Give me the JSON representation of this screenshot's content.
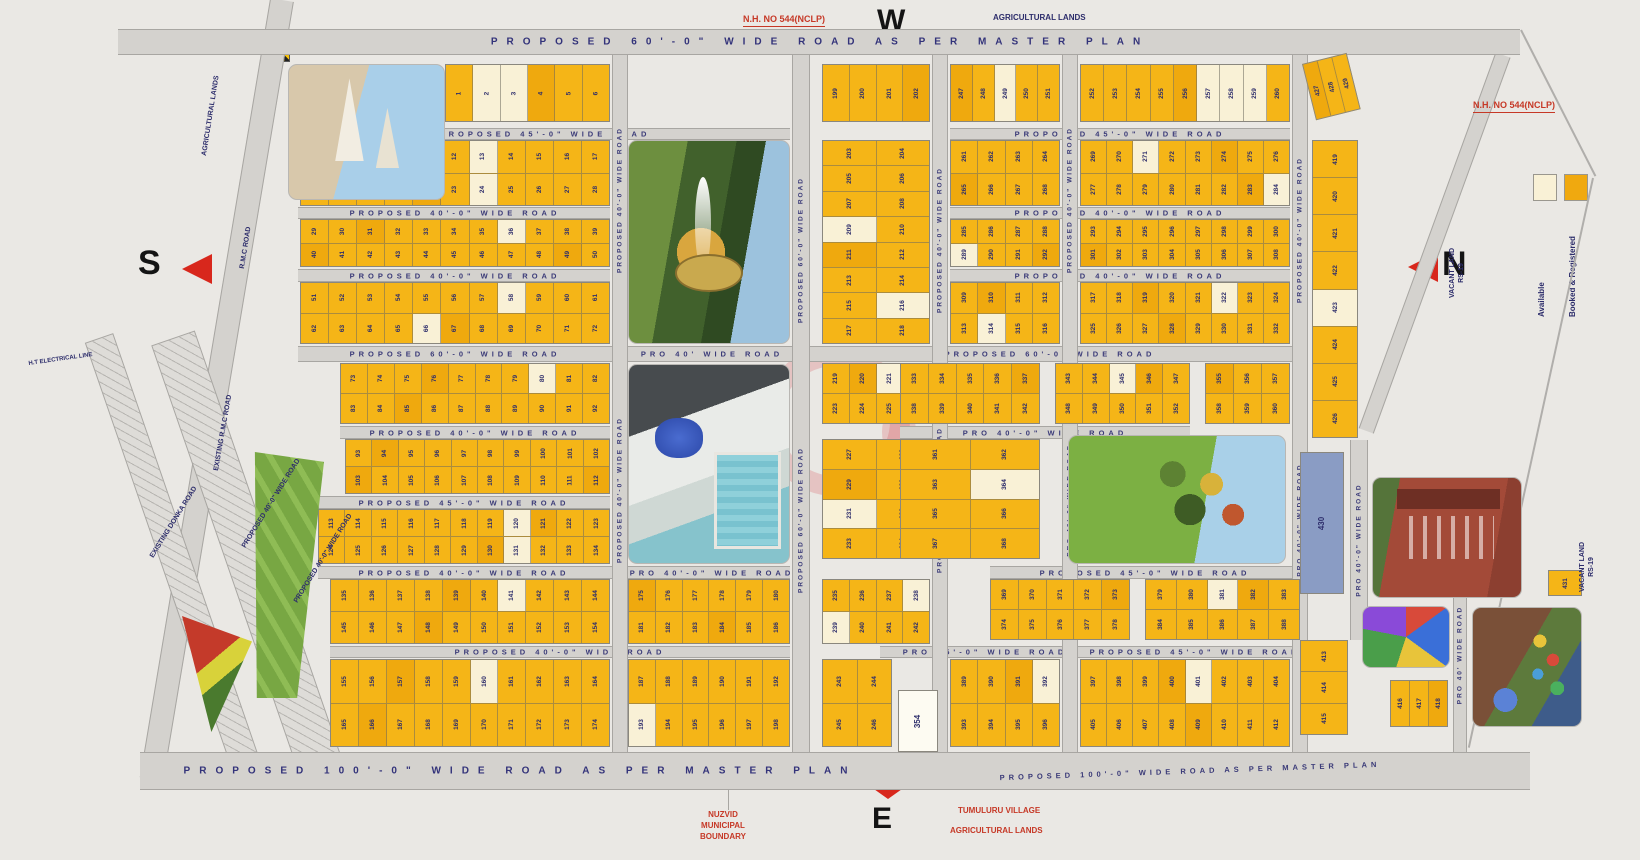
{
  "compass": {
    "west": "W",
    "south": "S",
    "north": "N",
    "east": "E"
  },
  "legend": {
    "available_label": "Available",
    "booked_label": "Booked & Registered",
    "available_color": "#F9F1D6",
    "booked_color": "#F0A90F"
  },
  "colors": {
    "booked": "#F5B517",
    "booked_alt": "#EFA90E",
    "available": "#F9F1D6",
    "navy": "#2D2D6B",
    "red": "#C63826",
    "road": "#D4D2CE",
    "blue_plot": "#8A9CC4"
  },
  "roads_h": [
    {
      "x": 118,
      "y": 29,
      "w": 1402,
      "h": 26,
      "labels": [
        {
          "t": "PROPOSED  60'-0\"  WIDE  ROAD  AS  PER  MASTER  PLAN",
          "cx": 820,
          "big": true
        }
      ]
    },
    {
      "x": 298,
      "y": 128,
      "w": 492,
      "h": 12,
      "labels": [
        {
          "t": "PROPOSED  45'-0\"  WIDE  ROAD",
          "cx": 545
        }
      ]
    },
    {
      "x": 950,
      "y": 128,
      "w": 340,
      "h": 12,
      "labels": [
        {
          "t": "PROPOSED  45'-0\"  WIDE  ROAD",
          "cx": 1120
        }
      ]
    },
    {
      "x": 298,
      "y": 207,
      "w": 312,
      "h": 12,
      "labels": [
        {
          "t": "PROPOSED  40'-0\"  WIDE  ROAD",
          "cx": 455
        }
      ]
    },
    {
      "x": 950,
      "y": 207,
      "w": 340,
      "h": 12,
      "labels": [
        {
          "t": "PROPOSED  40'-0\"  WIDE  ROAD",
          "cx": 1120
        }
      ]
    },
    {
      "x": 298,
      "y": 269,
      "w": 312,
      "h": 13,
      "labels": [
        {
          "t": "PROPOSED  40'-0\"  WIDE  ROAD",
          "cx": 455
        }
      ]
    },
    {
      "x": 950,
      "y": 269,
      "w": 340,
      "h": 13,
      "labels": [
        {
          "t": "PROPOSED  40'-0\"  WIDE  ROAD",
          "cx": 1120
        }
      ]
    },
    {
      "x": 298,
      "y": 346,
      "w": 1002,
      "h": 16,
      "labels": [
        {
          "t": "PROPOSED  60'-0\"  WIDE  ROAD",
          "cx": 455
        },
        {
          "t": "PRO  40'  WIDE  ROAD",
          "cx": 712
        },
        {
          "t": "PROPOSED  60'-0\"  WIDE  ROAD",
          "cx": 1050
        }
      ]
    },
    {
      "x": 340,
      "y": 426,
      "w": 270,
      "h": 13,
      "labels": [
        {
          "t": "PROPOSED  40'-0\"  WIDE  ROAD",
          "cx": 475
        }
      ]
    },
    {
      "x": 900,
      "y": 426,
      "w": 290,
      "h": 13,
      "labels": [
        {
          "t": "PRO  40'-0\"  WIDE  ROAD",
          "cx": 1045
        }
      ]
    },
    {
      "x": 318,
      "y": 496,
      "w": 292,
      "h": 13,
      "labels": [
        {
          "t": "PROPOSED  45'-0\"  WIDE  ROAD",
          "cx": 464
        }
      ]
    },
    {
      "x": 318,
      "y": 566,
      "w": 472,
      "h": 13,
      "labels": [
        {
          "t": "PROPOSED  40'-0\"  WIDE  ROAD",
          "cx": 464
        },
        {
          "t": "PRO  40'-0\"  WIDE  ROAD",
          "cx": 712
        }
      ]
    },
    {
      "x": 990,
      "y": 566,
      "w": 310,
      "h": 13,
      "labels": [
        {
          "t": "PROPOSED  45'-0\"  WIDE  ROAD",
          "cx": 1145
        }
      ]
    },
    {
      "x": 330,
      "y": 646,
      "w": 460,
      "h": 12,
      "labels": [
        {
          "t": "PROPOSED  40'-0\"  WIDE  ROAD",
          "cx": 560
        }
      ]
    },
    {
      "x": 880,
      "y": 646,
      "w": 420,
      "h": 12,
      "labels": [
        {
          "t": "PRO  45'-0\"  WIDE  ROAD",
          "cx": 985
        },
        {
          "t": "PROPOSED  45'-0\"  WIDE  ROAD",
          "cx": 1195
        }
      ]
    },
    {
      "x": 140,
      "y": 752,
      "w": 1390,
      "h": 38,
      "labels": [
        {
          "t": "PROPOSED  100'-0\"  WIDE  ROAD  AS  PER  MASTER  PLAN",
          "cx": 520,
          "big": true
        },
        {
          "t": "PROPOSED  100'-0\"  WIDE  ROAD  AS  PER  MASTER  PLAN",
          "cx": 1190,
          "rot": -2
        }
      ]
    }
  ],
  "roads_v": [
    {
      "x": 612,
      "y": 55,
      "w": 16,
      "h": 697,
      "labels": [
        {
          "t": "PROPOSED 40'-0\" WIDE ROAD",
          "cy": 200
        },
        {
          "t": "PROPOSED 40'-0\" WIDE ROAD",
          "cy": 490
        }
      ]
    },
    {
      "x": 792,
      "y": 55,
      "w": 18,
      "h": 697,
      "labels": [
        {
          "t": "PROPOSED 60'-0\" WIDE ROAD",
          "cy": 250
        },
        {
          "t": "PROPOSED 60'-0\" WIDE ROAD",
          "cy": 520
        }
      ]
    },
    {
      "x": 932,
      "y": 55,
      "w": 16,
      "h": 697,
      "labels": [
        {
          "t": "PROPOSED 40'-0\" WIDE ROAD",
          "cy": 240
        },
        {
          "t": "PROPOSED 40'-0\" WIDE ROAD",
          "cy": 500
        }
      ]
    },
    {
      "x": 1062,
      "y": 55,
      "w": 16,
      "h": 697,
      "labels": [
        {
          "t": "PROPOSED 40'-0\" WIDE ROAD",
          "cy": 200
        },
        {
          "t": "PRO 40'-0\" WIDE ROAD",
          "cy": 500
        }
      ]
    },
    {
      "x": 1292,
      "y": 55,
      "w": 16,
      "h": 697,
      "labels": [
        {
          "t": "PROPOSED 40'-0\" WIDE ROAD",
          "cy": 230
        },
        {
          "t": "PRO 40'-0\" WIDE ROAD",
          "cy": 520
        }
      ]
    },
    {
      "x": 1350,
      "y": 440,
      "w": 18,
      "h": 200,
      "labels": [
        {
          "t": "PRO 40'-0\" WIDE ROAD",
          "cy": 540
        }
      ]
    },
    {
      "x": 1453,
      "y": 560,
      "w": 14,
      "h": 192,
      "labels": [
        {
          "t": "PRO 40' WIDE ROAD",
          "cy": 655
        }
      ]
    }
  ],
  "roads_diag": [
    {
      "x": 270,
      "y": 0,
      "w": 24,
      "h": 790,
      "rot": 9.5,
      "cls": "dsolid"
    },
    {
      "x": 1495,
      "y": 55,
      "w": 16,
      "h": 400,
      "rot": 20,
      "cls": "dsolid"
    },
    {
      "x": 84,
      "y": 338,
      "w": 30,
      "h": 460,
      "rot": -19,
      "cls": "hatch"
    },
    {
      "x": 150,
      "y": 338,
      "w": 46,
      "h": 460,
      "rot": -19,
      "cls": "hatch"
    },
    {
      "x": 1592,
      "y": 178,
      "w": 2,
      "h": 583,
      "rot": 12.3,
      "cls": "dline"
    },
    {
      "x": 1520,
      "y": 30,
      "w": 2,
      "h": 164,
      "rot": -27,
      "cls": "dline"
    }
  ],
  "blocks": [
    {
      "x": 445,
      "y": 64,
      "w": 165,
      "h": 58,
      "s": 1,
      "r": 1,
      "c": 6,
      "a": [
        2,
        3
      ]
    },
    {
      "x": 300,
      "y": 140,
      "w": 310,
      "h": 66,
      "s": 7,
      "r": 2,
      "c": 11,
      "a": [
        13,
        24
      ]
    },
    {
      "x": 300,
      "y": 219,
      "w": 310,
      "h": 48,
      "s": 29,
      "r": 2,
      "c": 11,
      "a": [
        36
      ]
    },
    {
      "x": 300,
      "y": 282,
      "w": 310,
      "h": 62,
      "s": 51,
      "r": 2,
      "c": 11,
      "a": [
        58,
        66
      ]
    },
    {
      "x": 340,
      "y": 363,
      "w": 270,
      "h": 61,
      "s": 73,
      "r": 2,
      "c": 10,
      "a": [
        80
      ]
    },
    {
      "x": 345,
      "y": 439,
      "w": 265,
      "h": 55,
      "s": 93,
      "r": 2,
      "c": 10,
      "a": []
    },
    {
      "x": 318,
      "y": 509,
      "w": 292,
      "h": 55,
      "s": 113,
      "r": 2,
      "c": 11,
      "a": [
        120,
        131
      ]
    },
    {
      "x": 330,
      "y": 579,
      "w": 280,
      "h": 65,
      "s": 135,
      "r": 2,
      "c": 10,
      "a": [
        141
      ]
    },
    {
      "x": 330,
      "y": 659,
      "w": 280,
      "h": 88,
      "s": 155,
      "r": 2,
      "c": 10,
      "a": [
        160
      ]
    },
    {
      "x": 628,
      "y": 579,
      "w": 162,
      "h": 65,
      "s": 175,
      "r": 2,
      "c": 6,
      "a": []
    },
    {
      "x": 628,
      "y": 659,
      "w": 162,
      "h": 88,
      "s": 187,
      "r": 2,
      "c": 6,
      "a": [
        193
      ]
    },
    {
      "x": 822,
      "y": 64,
      "w": 108,
      "h": 58,
      "s": 199,
      "r": 1,
      "c": 4,
      "a": []
    },
    {
      "x": 822,
      "y": 140,
      "w": 108,
      "h": 204,
      "s": 203,
      "r": 8,
      "c": 2,
      "a": [
        209,
        216
      ]
    },
    {
      "x": 822,
      "y": 363,
      "w": 108,
      "h": 61,
      "s": 219,
      "r": 2,
      "c": 4,
      "a": [
        221
      ]
    },
    {
      "x": 822,
      "y": 439,
      "w": 108,
      "h": 120,
      "s": 227,
      "r": 4,
      "c": 2,
      "a": [
        231
      ]
    },
    {
      "x": 822,
      "y": 579,
      "w": 108,
      "h": 65,
      "s": 235,
      "r": 2,
      "c": 4,
      "a": [
        238,
        239
      ]
    },
    {
      "x": 822,
      "y": 659,
      "w": 70,
      "h": 88,
      "s": 243,
      "r": 2,
      "c": 2,
      "a": []
    },
    {
      "x": 950,
      "y": 64,
      "w": 110,
      "h": 58,
      "s": 247,
      "r": 1,
      "c": 5,
      "a": [
        249
      ]
    },
    {
      "x": 1080,
      "y": 64,
      "w": 210,
      "h": 58,
      "s": 252,
      "r": 1,
      "c": 9,
      "a": [
        257,
        258,
        259
      ]
    },
    {
      "x": 950,
      "y": 140,
      "w": 110,
      "h": 66,
      "s": 261,
      "r": 2,
      "c": 4,
      "a": []
    },
    {
      "x": 1080,
      "y": 140,
      "w": 210,
      "h": 66,
      "s": 269,
      "r": 2,
      "c": 8,
      "a": [
        271,
        284
      ]
    },
    {
      "x": 950,
      "y": 219,
      "w": 110,
      "h": 48,
      "s": 285,
      "r": 2,
      "c": 4,
      "a": [
        289
      ]
    },
    {
      "x": 1080,
      "y": 219,
      "w": 210,
      "h": 48,
      "s": 293,
      "r": 2,
      "c": 8,
      "a": []
    },
    {
      "x": 950,
      "y": 282,
      "w": 110,
      "h": 62,
      "s": 309,
      "r": 2,
      "c": 4,
      "a": [
        314
      ]
    },
    {
      "x": 1080,
      "y": 282,
      "w": 210,
      "h": 62,
      "s": 317,
      "r": 2,
      "c": 8,
      "a": [
        322
      ]
    },
    {
      "x": 900,
      "y": 363,
      "w": 140,
      "h": 61,
      "s": 333,
      "r": 2,
      "c": 5,
      "a": []
    },
    {
      "x": 1055,
      "y": 363,
      "w": 135,
      "h": 61,
      "s": 343,
      "r": 2,
      "c": 5,
      "a": [
        345
      ]
    },
    {
      "x": 1205,
      "y": 363,
      "w": 85,
      "h": 61,
      "s": 355,
      "r": 2,
      "c": 3,
      "a": []
    },
    {
      "x": 900,
      "y": 439,
      "w": 140,
      "h": 120,
      "s": 361,
      "r": 4,
      "c": 2,
      "a": [
        364
      ]
    },
    {
      "x": 990,
      "y": 579,
      "w": 140,
      "h": 61,
      "s": 369,
      "r": 2,
      "c": 5,
      "a": []
    },
    {
      "x": 1145,
      "y": 579,
      "w": 155,
      "h": 61,
      "s": 379,
      "r": 2,
      "c": 5,
      "a": [
        381
      ]
    },
    {
      "x": 950,
      "y": 659,
      "w": 110,
      "h": 88,
      "s": 389,
      "r": 2,
      "c": 4,
      "a": [
        392
      ]
    },
    {
      "x": 1080,
      "y": 659,
      "w": 210,
      "h": 88,
      "s": 397,
      "r": 2,
      "c": 8,
      "a": [
        401
      ]
    },
    {
      "x": 1300,
      "y": 640,
      "w": 48,
      "h": 95,
      "s": 413,
      "r": 3,
      "c": 1,
      "a": []
    },
    {
      "x": 1390,
      "y": 680,
      "w": 58,
      "h": 47,
      "s": 416,
      "r": 1,
      "c": 3,
      "a": []
    },
    {
      "x": 1312,
      "y": 140,
      "w": 46,
      "h": 298,
      "s": 419,
      "r": 8,
      "c": 1,
      "a": [
        423
      ]
    },
    {
      "x": 1302,
      "y": 64,
      "w": 46,
      "h": 58,
      "s": 427,
      "r": 1,
      "c": 3,
      "a": [],
      "rot": -14
    },
    {
      "x": 1548,
      "y": 570,
      "w": 34,
      "h": 26,
      "s": 431,
      "r": 1,
      "c": 1,
      "a": []
    }
  ],
  "special_plots": [
    {
      "name": "plot-354",
      "n": "354",
      "x": 898,
      "y": 690,
      "w": 40,
      "h": 62,
      "bg": "#FDFBF2"
    },
    {
      "name": "plot-amenity",
      "n": "430",
      "x": 1300,
      "y": 452,
      "w": 44,
      "h": 142,
      "bg": "#8A9CC4"
    }
  ],
  "photos": [
    {
      "kind": "temple",
      "x": 288,
      "y": 64,
      "w": 157,
      "h": 136
    },
    {
      "kind": "fountain",
      "x": 628,
      "y": 140,
      "w": 162,
      "h": 204
    },
    {
      "kind": "club",
      "x": 628,
      "y": 364,
      "w": 162,
      "h": 200
    },
    {
      "kind": "park",
      "x": 1068,
      "y": 435,
      "w": 218,
      "h": 129
    },
    {
      "kind": "school",
      "x": 1372,
      "y": 477,
      "w": 150,
      "h": 121
    },
    {
      "kind": "kids",
      "x": 1362,
      "y": 606,
      "w": 88,
      "h": 62
    },
    {
      "kind": "play",
      "x": 1472,
      "y": 607,
      "w": 110,
      "h": 120
    },
    {
      "kind": "tri1",
      "x": 228,
      "y": 452,
      "w": 96,
      "h": 246
    },
    {
      "kind": "tri2",
      "x": 182,
      "y": 616,
      "w": 70,
      "h": 116
    }
  ],
  "labels": [
    {
      "t": "N.H. NO 544(NCLP)",
      "x": 743,
      "y": 13,
      "size": 9,
      "c": "red",
      "u": true
    },
    {
      "t": "AGRICULTURAL LANDS",
      "x": 993,
      "y": 13,
      "size": 8,
      "c": "navy"
    },
    {
      "t": "N.H. NO 544(NCLP)",
      "x": 1473,
      "y": 99,
      "size": 9,
      "c": "red",
      "u": true
    },
    {
      "t": "NUZVID\nMUNICIPAL\nBOUNDARY",
      "x": 700,
      "y": 810,
      "size": 8,
      "c": "red"
    },
    {
      "t": "TUMULURU VILLAGE",
      "x": 958,
      "y": 806,
      "size": 8,
      "c": "red"
    },
    {
      "t": "AGRICULTURAL LANDS",
      "x": 950,
      "y": 826,
      "size": 8,
      "c": "red"
    },
    {
      "t": "VACANT LAND\nRS-19",
      "x": 1448,
      "y": 298,
      "size": 7,
      "c": "navy",
      "rot": -90
    },
    {
      "t": "VACANT LAND\nRS-19",
      "x": 1578,
      "y": 592,
      "size": 7,
      "c": "navy",
      "rot": -90
    },
    {
      "t": "AGRICULTURAL LANDS",
      "x": 200,
      "y": 155,
      "size": 7,
      "c": "navy",
      "rot": -81
    },
    {
      "t": "R.M.C ROAD",
      "x": 238,
      "y": 268,
      "size": 7,
      "c": "navy",
      "rot": -81
    },
    {
      "t": "EXISTING R.M.C ROAD",
      "x": 212,
      "y": 470,
      "size": 7,
      "c": "navy",
      "rot": -80
    },
    {
      "t": "EXISTING DONKA ROAD",
      "x": 148,
      "y": 555,
      "size": 7,
      "c": "navy",
      "rot": -58
    },
    {
      "t": "PROPOSED 40'-0\" WIDE ROAD",
      "x": 240,
      "y": 545,
      "size": 7,
      "c": "navy",
      "rot": -58
    },
    {
      "t": "PROPOSED 40'-0\" WIDE ROAD",
      "x": 292,
      "y": 600,
      "size": 7,
      "c": "navy",
      "rot": -58
    },
    {
      "t": "H.T ELECTRICAL LINE",
      "x": 28,
      "y": 360,
      "size": 6,
      "c": "navy",
      "rot": -8
    }
  ]
}
